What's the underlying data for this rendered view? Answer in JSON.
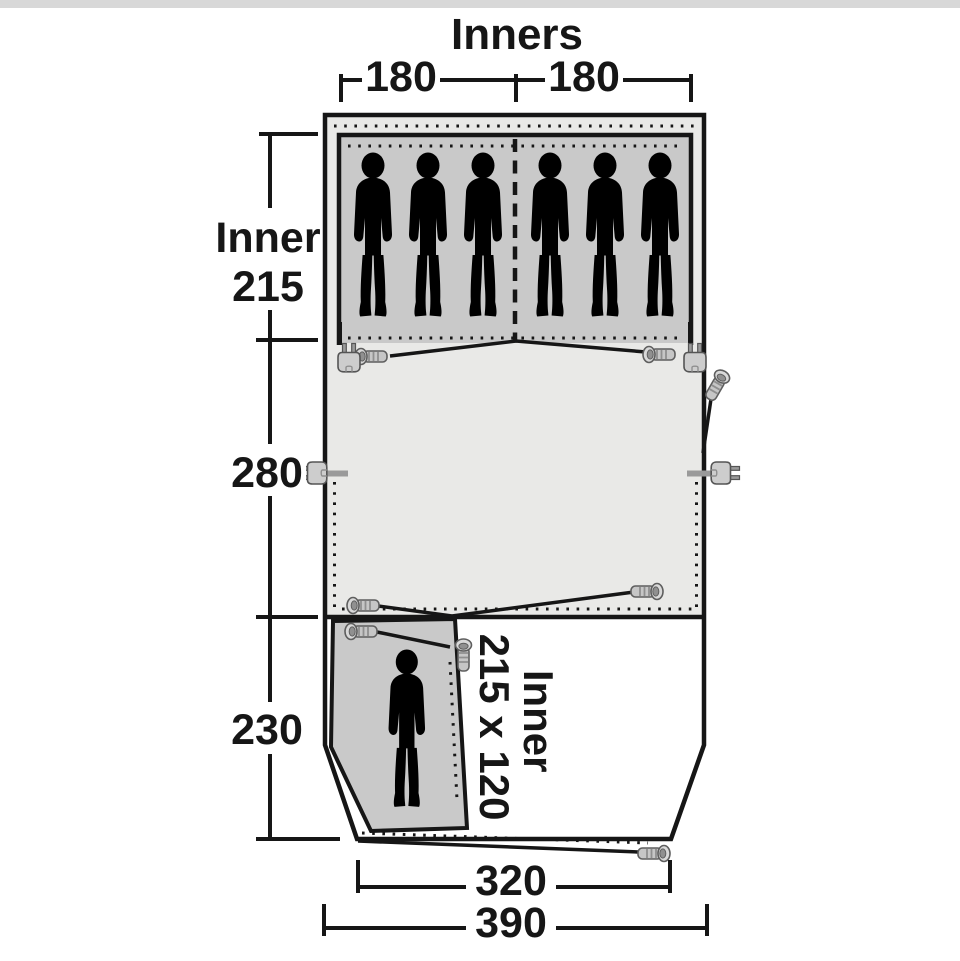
{
  "page": {
    "background_color": "#ffffff",
    "top_strip_color": "#d8d8d8"
  },
  "diagram": {
    "type": "tent-floorplan",
    "title": "Inners",
    "colors": {
      "outline": "#161616",
      "sleeping_inner_fill": "#c9c9c9",
      "living_area_fill": "#e9e9e7",
      "front_area_fill": "#ffffff",
      "hardware_fill": "#c6c6c6",
      "hardware_stroke": "#5e5e5e"
    },
    "dimensions": {
      "top_inner_left": "180",
      "top_inner_right": "180",
      "left_sleeping_depth_word": "Inner",
      "left_sleeping_depth_value": "215",
      "left_living_depth": "280",
      "left_front_depth": "230",
      "small_inner_word": "Inner",
      "small_inner_size": "215 x 120",
      "bottom_inner_width": "320",
      "bottom_outer_width": "390"
    },
    "occupants": {
      "sleeping_inner_count": 6,
      "small_inner_count": 1
    },
    "icons": [
      "person-icon",
      "tent-peg-icon",
      "power-plug-icon"
    ]
  }
}
